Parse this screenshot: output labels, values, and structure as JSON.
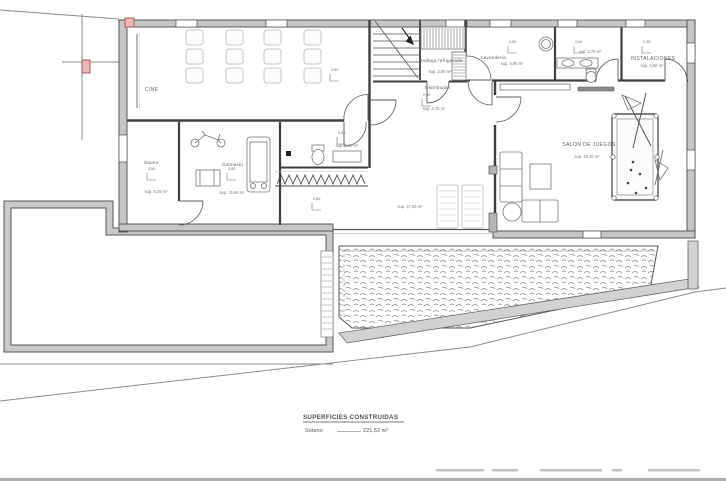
{
  "drawing": {
    "kind": "architectural basement floor plan",
    "colors": {
      "paper": "#ffffff",
      "wall_fill": "#c6c6c6",
      "wall_stroke": "#4a4a4a",
      "line": "#555555",
      "light_furniture": "#c9c9c9",
      "band_fill": "#d2d2d2",
      "marker_red_stroke": "#b05656",
      "marker_red_fill": "#eab7b7",
      "label_text": "#5a5a5a"
    }
  },
  "rooms": {
    "cine": {
      "name": "CINE",
      "height": "2,60"
    },
    "sauna": {
      "name": "Sauna",
      "height": "2,60",
      "area": "sup. 5,25 m²"
    },
    "gimnasio": {
      "name": "Gimnasio",
      "height": "2,60",
      "area": "sup. 15,86 m²"
    },
    "vestuario": {
      "height": "2,60",
      "area": "sup. 5,50 m²"
    },
    "bodega": {
      "name": "Bodega refrigerado",
      "area": "sup. 3,50 m²"
    },
    "distribuidor": {
      "name": "Distribuidor",
      "height": "2,60",
      "area": "sup. 3,75 m²"
    },
    "lavanderia": {
      "name": "Lavandería",
      "height": "2,60",
      "area": "sup. 4,90 m²"
    },
    "aseo": {
      "height": "2,60",
      "area": "sup. 3,70 m²"
    },
    "instalaciones": {
      "name": "INSTALACIONES",
      "height": "2,35",
      "area": "sup. 5,50 m²"
    },
    "salon": {
      "name": "SALON DE JUEGOS",
      "area": "sup. 45,40 m²"
    },
    "central": {
      "height": "2,60",
      "area": "sup. 47,06 m²"
    }
  },
  "summary": {
    "title": "SUPERFICIES CONSTRUIDAS",
    "sotano_label": "Sótano",
    "sotano_value": "221,52 m²"
  }
}
